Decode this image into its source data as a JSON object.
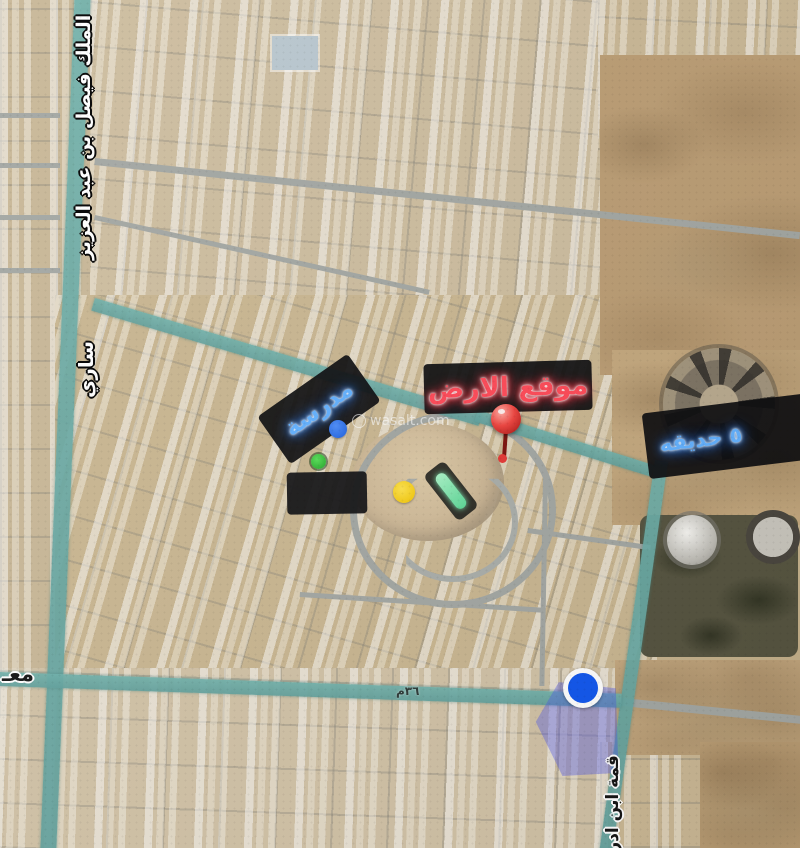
{
  "map": {
    "watermark": "wasalt.com",
    "street_labels": {
      "king_faisal_road": "الملك فيصل بن عبد العزيز",
      "sari_street": "ساري",
      "partial_word_left": "معـ",
      "road_width": "٣٦م",
      "ibn_idris_street": "قمة ابن ادريس"
    },
    "overlay_labels": {
      "land_location": "موقع الارض",
      "school": "مدرسة",
      "park": "٥ حديقه"
    },
    "marker_colors": {
      "location_pin": "#d63230",
      "blue_dot": "#1e6ef5",
      "green_dot": "#2fbf3a",
      "yellow_dot": "#ffd60a",
      "area_circle": "#1257ee",
      "highlight_polygon": "#4b55eb",
      "distance_capsule": "#7de8b0"
    },
    "theme_colors": {
      "highlighted_road": "#6fb0aa",
      "label_background": "#101012",
      "land_label_text": "#ff4a58",
      "school_label_text": "#58adff",
      "park_label_text": "#6fb6ff"
    }
  }
}
